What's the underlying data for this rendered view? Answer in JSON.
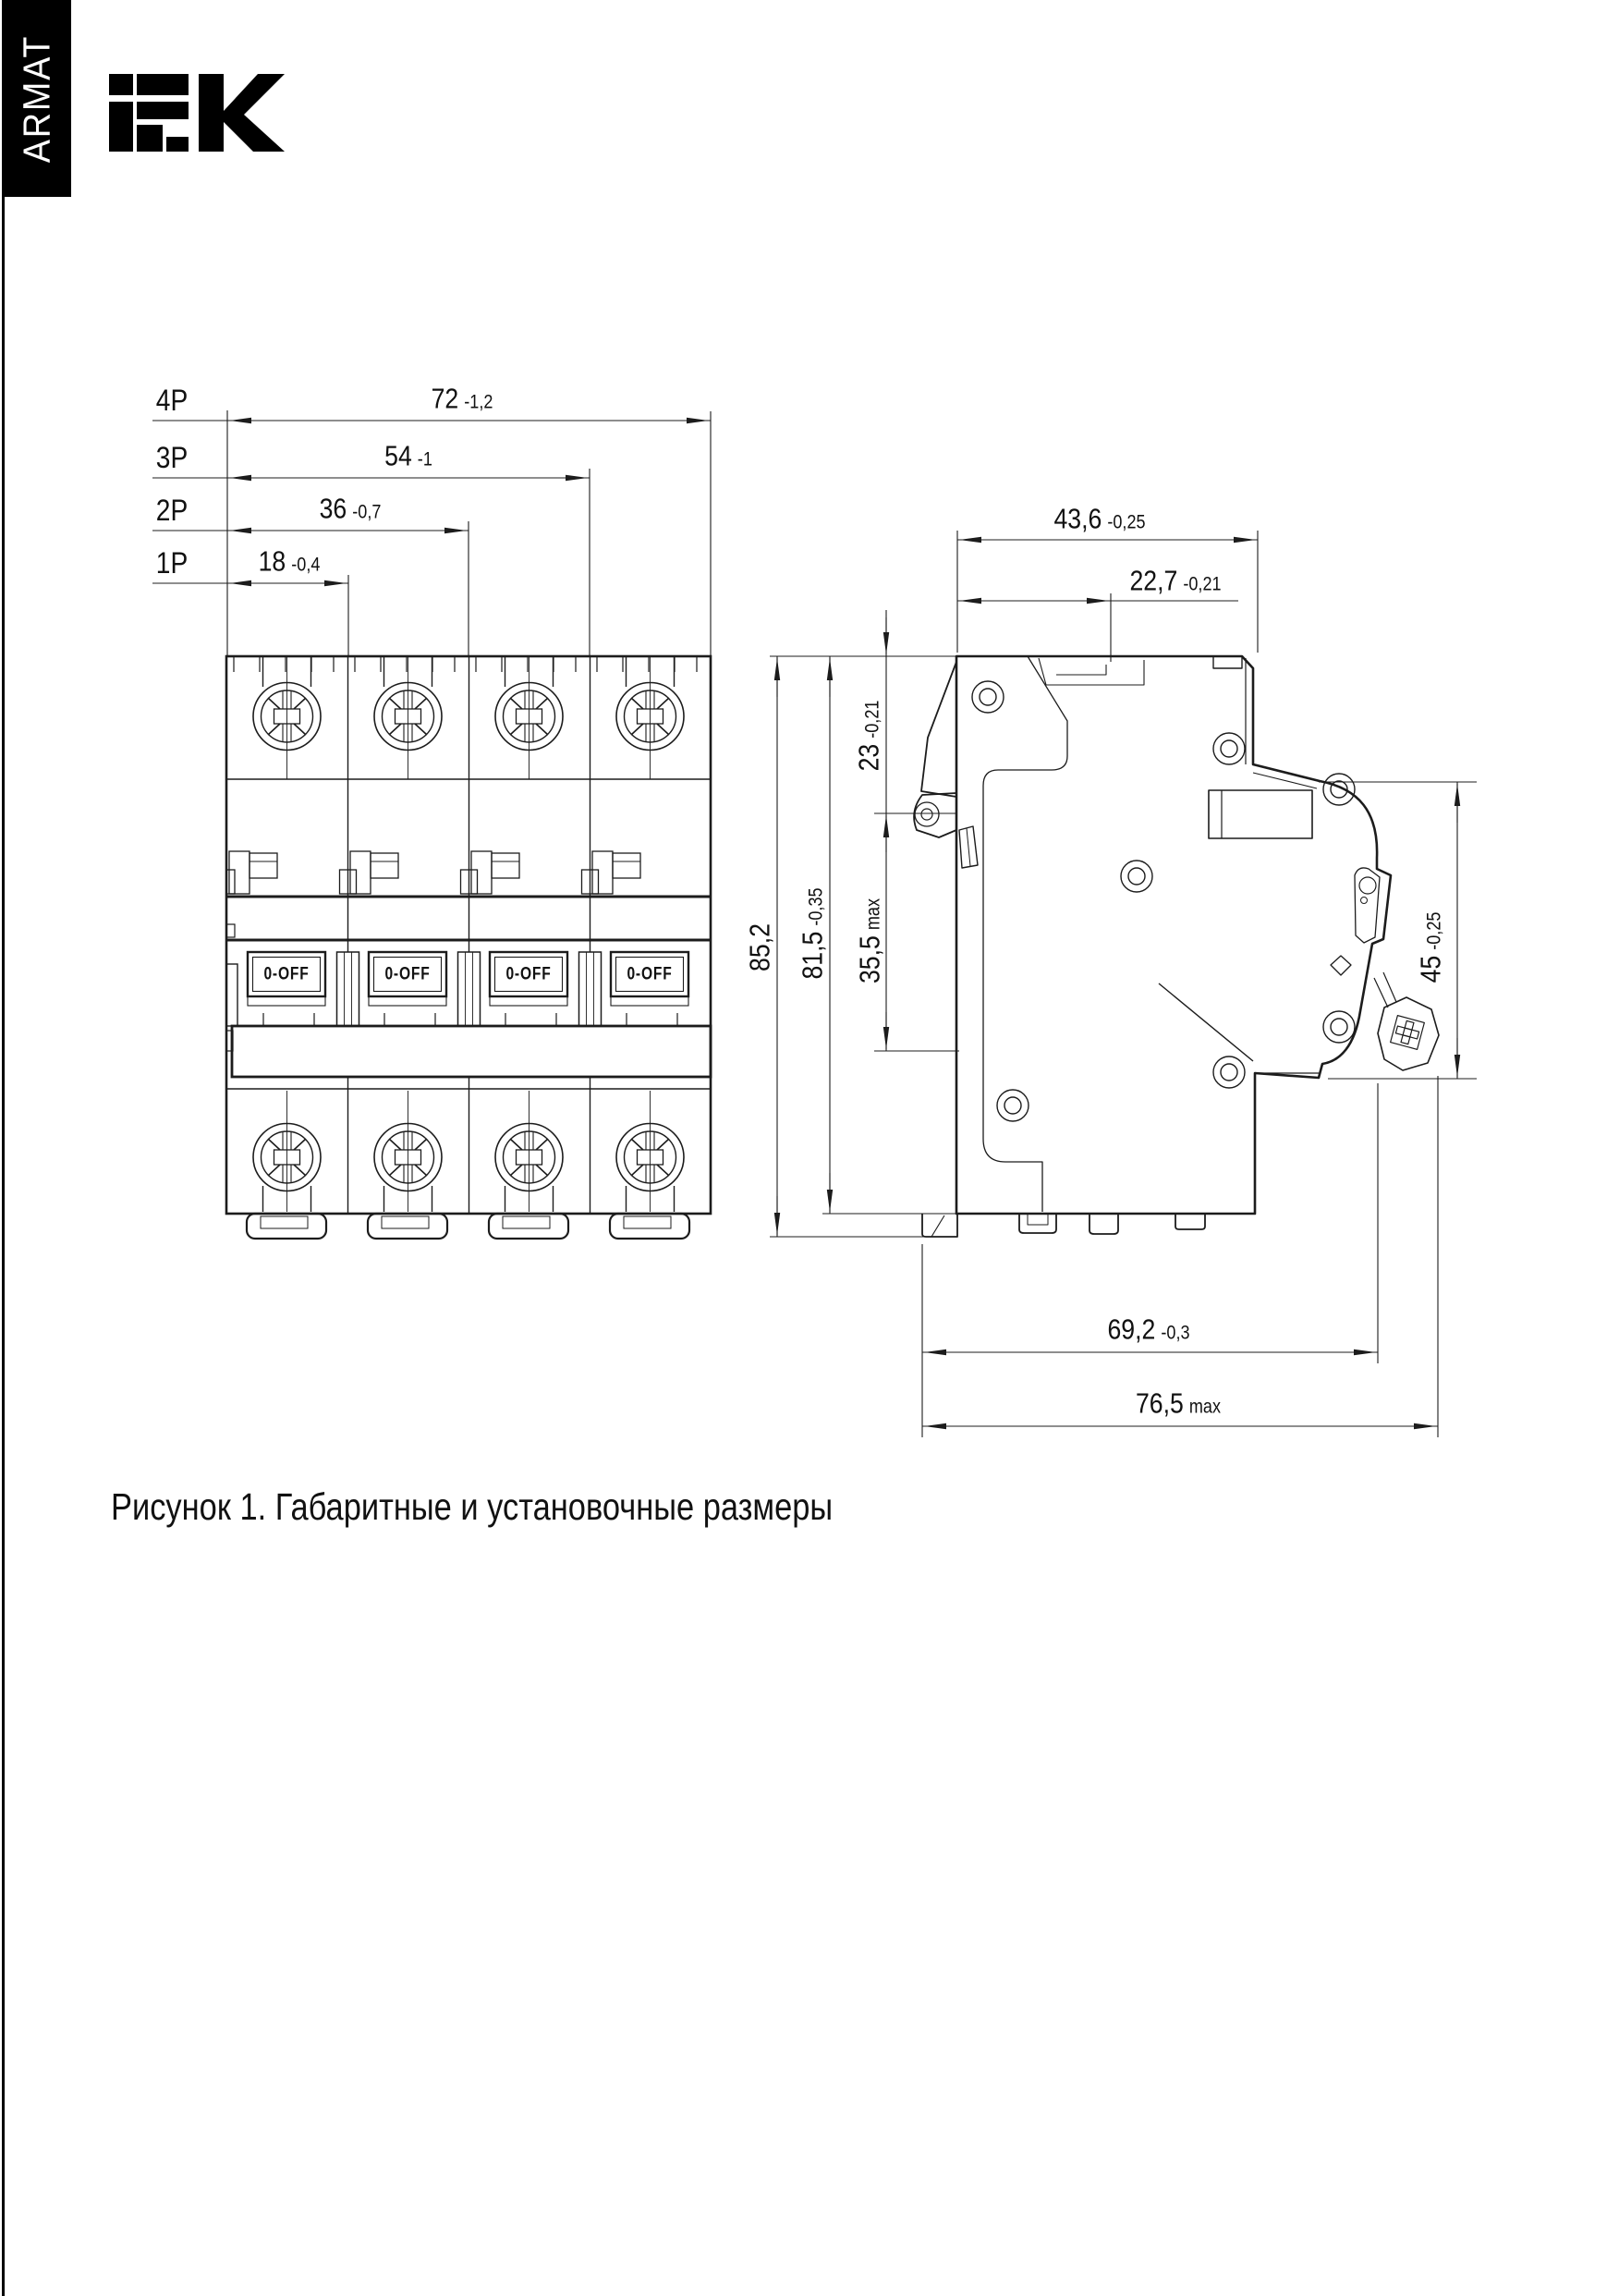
{
  "brand": {
    "vertical_label": "ARMAT",
    "logo_text": "iek"
  },
  "front_view": {
    "rows": [
      {
        "pole": "4P",
        "value": "72",
        "tol": "-1,2"
      },
      {
        "pole": "3P",
        "value": "54",
        "tol": "-1"
      },
      {
        "pole": "2P",
        "value": "36",
        "tol": "-0,7"
      },
      {
        "pole": "1P",
        "value": "18",
        "tol": "-0,4"
      }
    ],
    "toggle_labels": [
      "0-OFF",
      "0-OFF",
      "0-OFF",
      "0-OFF"
    ]
  },
  "side_view": {
    "dim_depth_top": {
      "value": "43,6",
      "tol": "-0,25"
    },
    "dim_din_center": {
      "value": "22,7",
      "tol": "-0,21"
    },
    "dim_top_to_clip": {
      "value": "23",
      "tol": "-0,21"
    },
    "dim_rail_zone": {
      "value": "35,5",
      "tol": "max"
    },
    "dim_height_body": {
      "value": "81,5",
      "tol": "-0,35"
    },
    "dim_height_total": {
      "value": "85,2",
      "tol": ""
    },
    "dim_front_face": {
      "value": "45",
      "tol": "-0,25"
    },
    "dim_depth_mount": {
      "value": "69,2",
      "tol": "-0,3"
    },
    "dim_depth_max": {
      "value": "76,5",
      "tol": "max"
    }
  },
  "caption": "Рисунок 1. Габаритные и установочные размеры",
  "colors": {
    "line": "#1c1c1c",
    "brand_bg": "#000000",
    "page_bg": "#ffffff"
  }
}
